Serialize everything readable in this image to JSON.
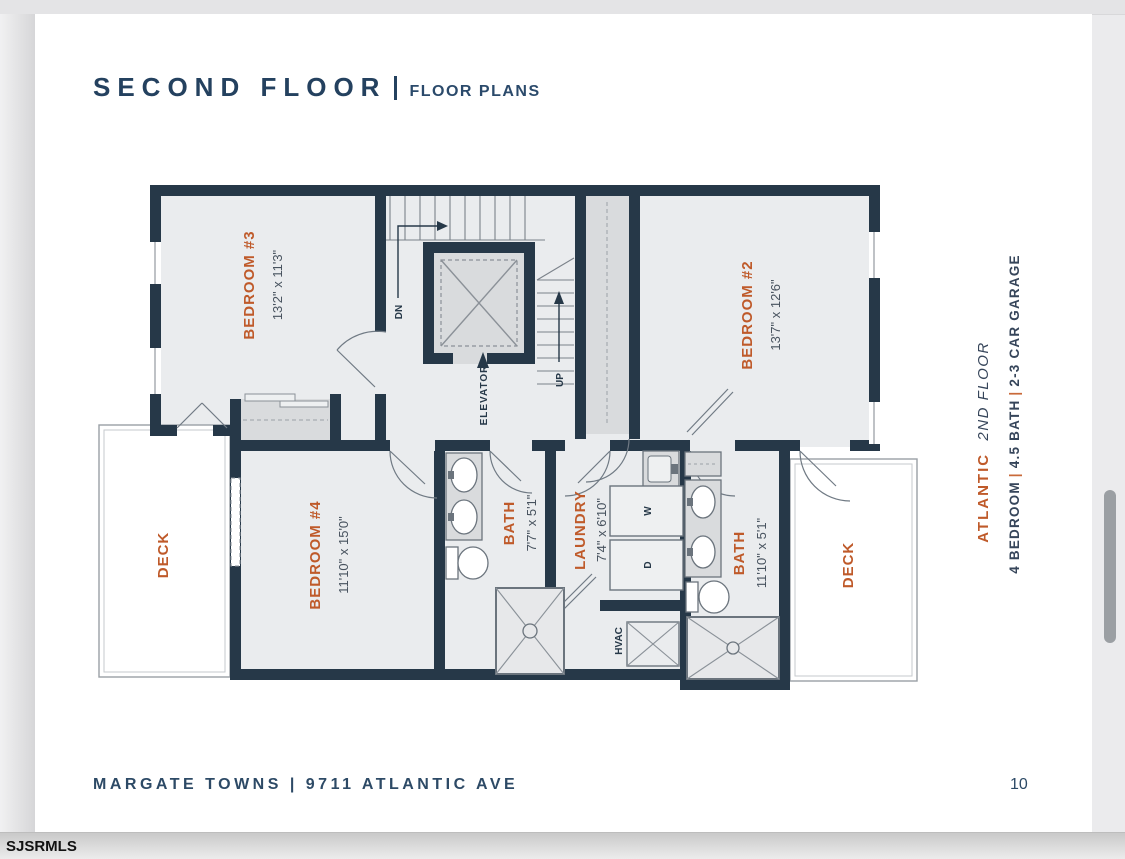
{
  "header": {
    "title": "SECOND FLOOR",
    "subtitle": "FLOOR PLANS"
  },
  "footer": {
    "text": "MARGATE TOWNS | 9711 ATLANTIC AVE",
    "page_number": "10"
  },
  "sidebar": {
    "plan_name": "ATLANTIC",
    "floor": "2ND FLOOR",
    "spec_bedroom": "4 BEDROOM",
    "spec_bath": "4.5 BATH",
    "spec_garage": "2-3 CAR GARAGE",
    "separator": "|"
  },
  "chrome": {
    "watermark": "SJSRMLS"
  },
  "plan": {
    "bedroom3": {
      "name": "BEDROOM #3",
      "dims": "13'2\" x 11'3\""
    },
    "bedroom2": {
      "name": "BEDROOM #2",
      "dims": "13'7\" x 12'6\""
    },
    "bedroom4": {
      "name": "BEDROOM #4",
      "dims": "11'10\" x 15'0\""
    },
    "bath_main": {
      "name": "BATH",
      "dims": "7'7\" x 5'1\""
    },
    "laundry": {
      "name": "LAUNDRY",
      "dims": "7'4\" x 6'10\""
    },
    "bath_right": {
      "name": "BATH",
      "dims": "11'10\" x 5'1\""
    },
    "deck_left": "DECK",
    "deck_right": "DECK",
    "elevator": "ELEVATOR",
    "hvac": "HVAC",
    "dn": "DN",
    "up": "UP",
    "washer": "W",
    "dryer": "D"
  },
  "colors": {
    "accent_orange": "#bf5a2a",
    "navy": "#24415f",
    "wall": "#263848"
  }
}
